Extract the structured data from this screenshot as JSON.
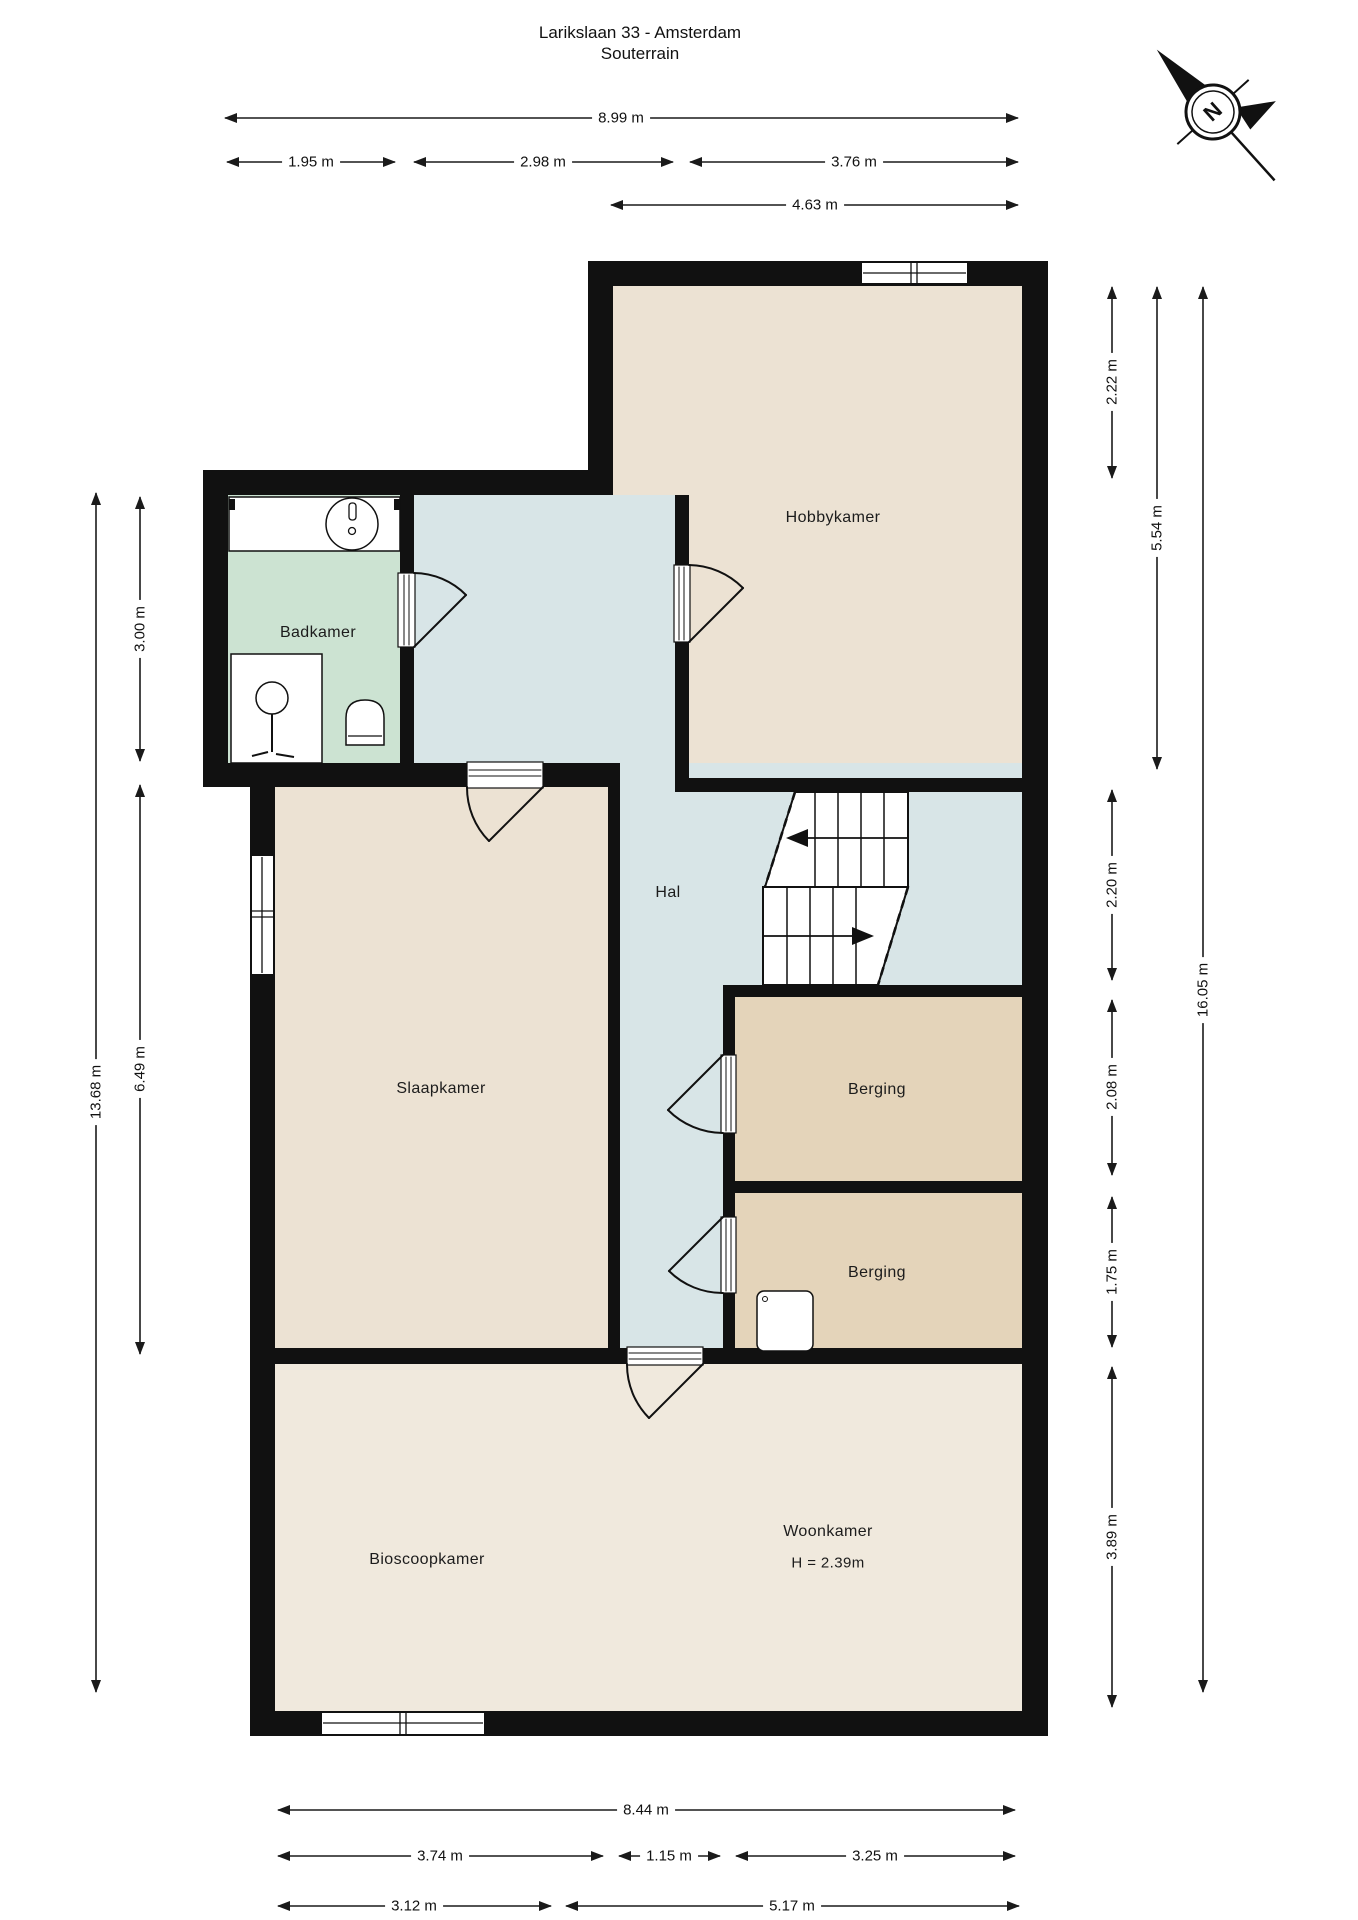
{
  "title": {
    "line1": "Larikslaan 33 - Amsterdam",
    "line2": "Souterrain"
  },
  "compass": {
    "label": "N"
  },
  "rooms": {
    "hobbykamer": "Hobbykamer",
    "badkamer": "Badkamer",
    "hal": "Hal",
    "slaapkamer": "Slaapkamer",
    "berging1": "Berging",
    "berging2": "Berging",
    "bioscoopkamer": "Bioscoopkamer",
    "woonkamer": "Woonkamer",
    "woonkamer_height": "H = 2.39m"
  },
  "dimensions": {
    "top_total": "8.99 m",
    "top_1": "1.95 m",
    "top_2": "2.98 m",
    "top_3": "3.76 m",
    "top_4": "4.63 m",
    "right_1": "2.22 m",
    "right_2": "5.54 m",
    "right_3": "2.20 m",
    "right_4": "2.08 m",
    "right_5": "1.75 m",
    "right_6": "3.89 m",
    "right_total": "16.05 m",
    "left_total": "13.68 m",
    "left_1": "3.00 m",
    "left_2": "6.49 m",
    "bottom_total": "8.44 m",
    "bottom_1": "3.74 m",
    "bottom_2": "1.15 m",
    "bottom_3": "3.25 m",
    "bottom_4": "3.12 m",
    "bottom_5": "5.17 m"
  },
  "colors": {
    "wall": "#111111",
    "room_beige": "#ece2d3",
    "hal_blue": "#d8e5e7",
    "badkamer_green": "#cce3d2",
    "berging_tan": "#e4d4ba",
    "bottom_beige": "#f0e9dd"
  }
}
